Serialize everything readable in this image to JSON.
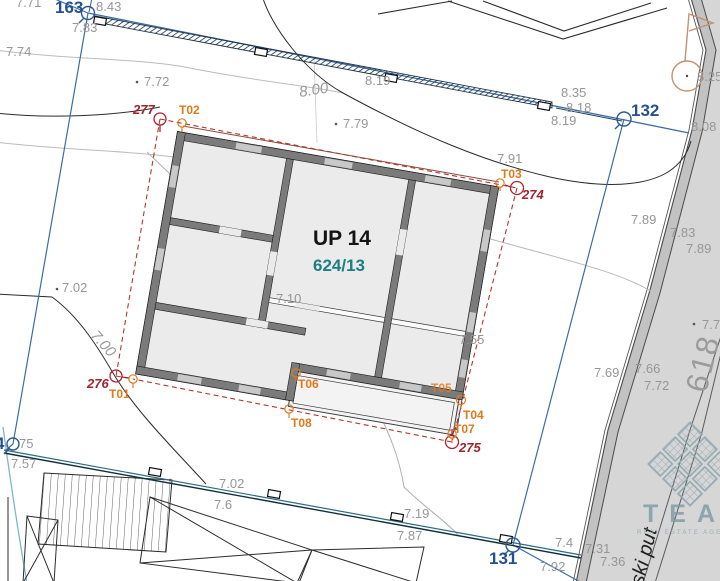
{
  "plan": {
    "unit_label": "UP 14",
    "parcel_label": "624/13"
  },
  "road": {
    "parcel_number": "618",
    "street_name": "ski put"
  },
  "watermark": {
    "brand": "TEAM",
    "tagline": "REAL ESTATE AGEN"
  },
  "boundary_points": {
    "blue": [
      {
        "id": "163"
      },
      {
        "id": "132"
      },
      {
        "id": "131"
      },
      {
        "id": "4"
      }
    ],
    "red": [
      {
        "id": "277"
      },
      {
        "id": "274"
      },
      {
        "id": "275"
      },
      {
        "id": "276"
      }
    ]
  },
  "survey_points": [
    {
      "id": "T01"
    },
    {
      "id": "T02"
    },
    {
      "id": "T03"
    },
    {
      "id": "T04"
    },
    {
      "id": "T05"
    },
    {
      "id": "T06"
    },
    {
      "id": "T07"
    },
    {
      "id": "T08"
    }
  ],
  "elevations": [
    {
      "v": "7.71"
    },
    {
      "v": "8.43"
    },
    {
      "v": "7.83"
    },
    {
      "v": "7.74"
    },
    {
      "v": "7.72"
    },
    {
      "v": "8.00"
    },
    {
      "v": "8.19"
    },
    {
      "v": "7.79"
    },
    {
      "v": "8.35"
    },
    {
      "v": "8.18"
    },
    {
      "v": "8.19"
    },
    {
      "v": "8.25"
    },
    {
      "v": "8.08"
    },
    {
      "v": "7.91"
    },
    {
      "v": "7.89"
    },
    {
      "v": "7.83"
    },
    {
      "v": "7.89"
    },
    {
      "v": "7.02"
    },
    {
      "v": "7.00"
    },
    {
      "v": "7.10"
    },
    {
      "v": "7.55"
    },
    {
      "v": "7.69"
    },
    {
      "v": "7.66"
    },
    {
      "v": "7.72"
    },
    {
      "v": "7.7"
    },
    {
      "v": "75"
    },
    {
      "v": "7.57"
    },
    {
      "v": "7.02"
    },
    {
      "v": "7.6"
    },
    {
      "v": "7.19"
    },
    {
      "v": "7.87"
    },
    {
      "v": "7.4"
    },
    {
      "v": "7.92"
    },
    {
      "v": "7.31"
    },
    {
      "v": "7.36"
    }
  ],
  "colors": {
    "boundary_blue": "#3c6ca3",
    "parcel_dashed_red": "#b5352b",
    "survey_orange": "#e0791c",
    "marker_dark_red": "#a2232e",
    "parcel_teal": "#1c7f81",
    "road_gray": "#d6d6d6",
    "wall_gray": "#7b7b7b"
  }
}
